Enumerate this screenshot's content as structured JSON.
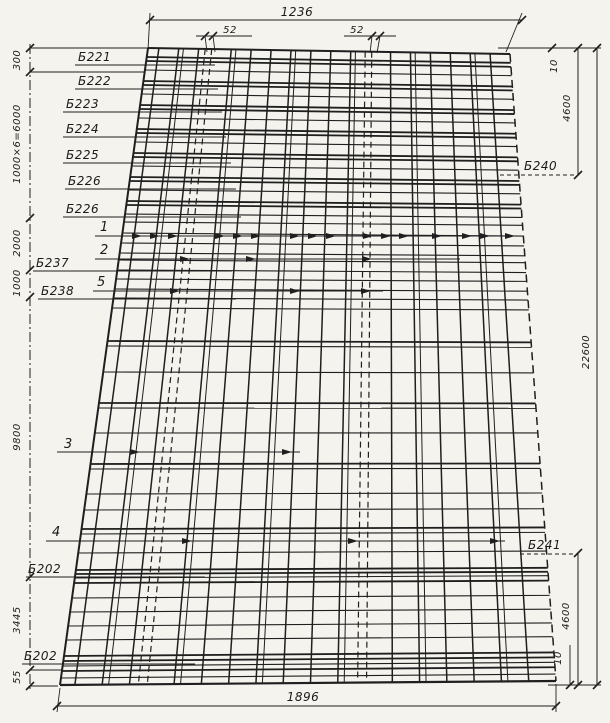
{
  "drawing": {
    "type": "slab-reinforcement-plan",
    "ink_color": "#1f1f1f",
    "paper_color": "#f4f3ee",
    "dimensions": {
      "top_width": "1236",
      "gap_left": "52",
      "gap_right": "52",
      "bottom_width": "1896",
      "left_chain": {
        "d300": "300",
        "d6000": "1000×6=6000",
        "d2000": "2000",
        "d1000": "1000",
        "d9800": "9800",
        "d3445": "3445",
        "d55": "55"
      },
      "right_chain": {
        "d10_top": "10",
        "d4600_top": "4600",
        "d22600": "22600",
        "d4600_bottom": "4600",
        "d10_bottom": "10"
      }
    },
    "beam_labels": {
      "b221": "Б221",
      "b222": "Б222",
      "b223": "Б223",
      "b224": "Б224",
      "b225": "Б225",
      "b226a": "Б226",
      "b226b": "Б226",
      "b237": "Б237",
      "b238": "Б238",
      "b202a": "Б202",
      "b202b": "Б202",
      "b240": "Б240",
      "b241": "Б241"
    },
    "row_markers": {
      "r1": "1",
      "r2": "2",
      "r5": "5",
      "r3": "3",
      "r4": "4"
    }
  }
}
